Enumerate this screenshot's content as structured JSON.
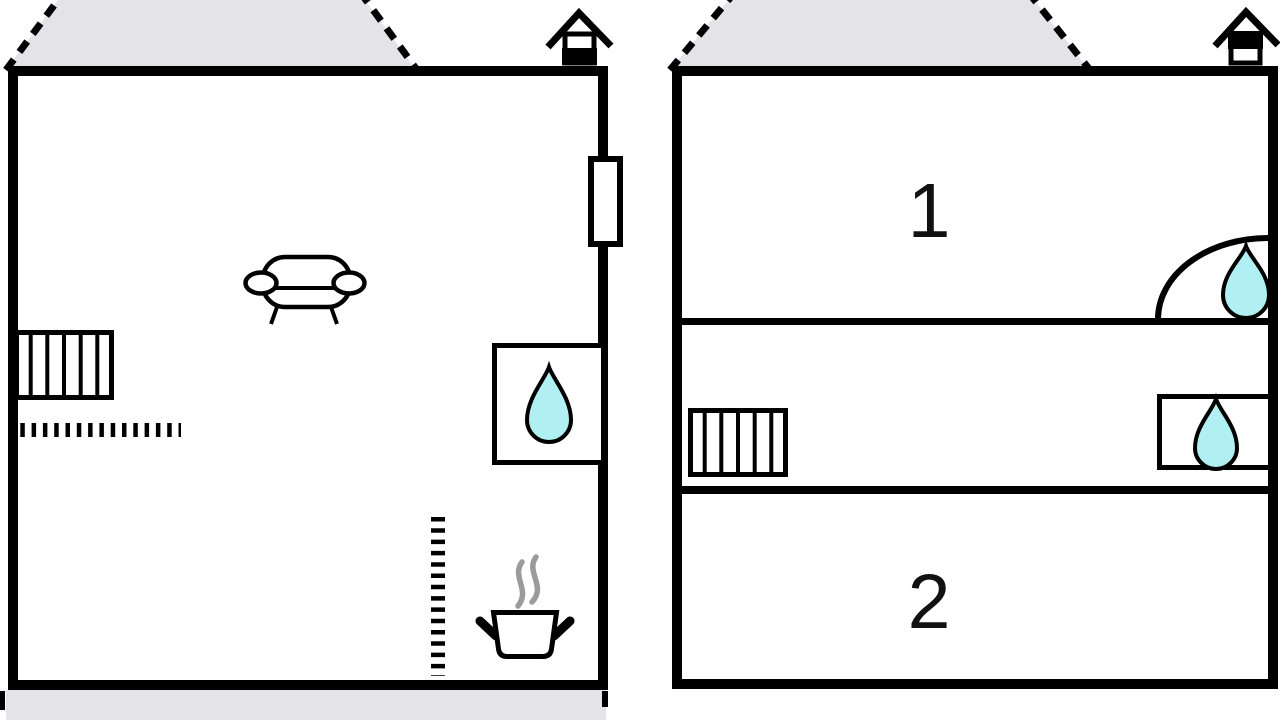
{
  "canvas": {
    "width": 1280,
    "height": 720,
    "background": "#ffffff"
  },
  "colors": {
    "wall": "#000000",
    "roof_shade": "#e4e4e8",
    "water": "#b0f0f2",
    "steam": "#9b9b9b",
    "label": "#111111"
  },
  "plans": {
    "left": {
      "name": "ground-floor",
      "storey_indicator": "lower-level-filled",
      "labels": {},
      "features": [
        "roof-gable-dashed",
        "storey-indicator",
        "window",
        "sofa",
        "radiator",
        "partition-dashed-line",
        "sink-water-drop",
        "stove-pot-with-steam",
        "stair-dashed-line",
        "roof-shade-bottom"
      ]
    },
    "right": {
      "name": "upper-floor",
      "storey_indicator": "upper-level-filled",
      "labels": {
        "room_1": "1",
        "room_2": "2"
      },
      "features": [
        "roof-gable-dashed",
        "storey-indicator",
        "door-swing-arc",
        "sink-water-drop",
        "radiator",
        "sink-water-drop"
      ]
    }
  }
}
